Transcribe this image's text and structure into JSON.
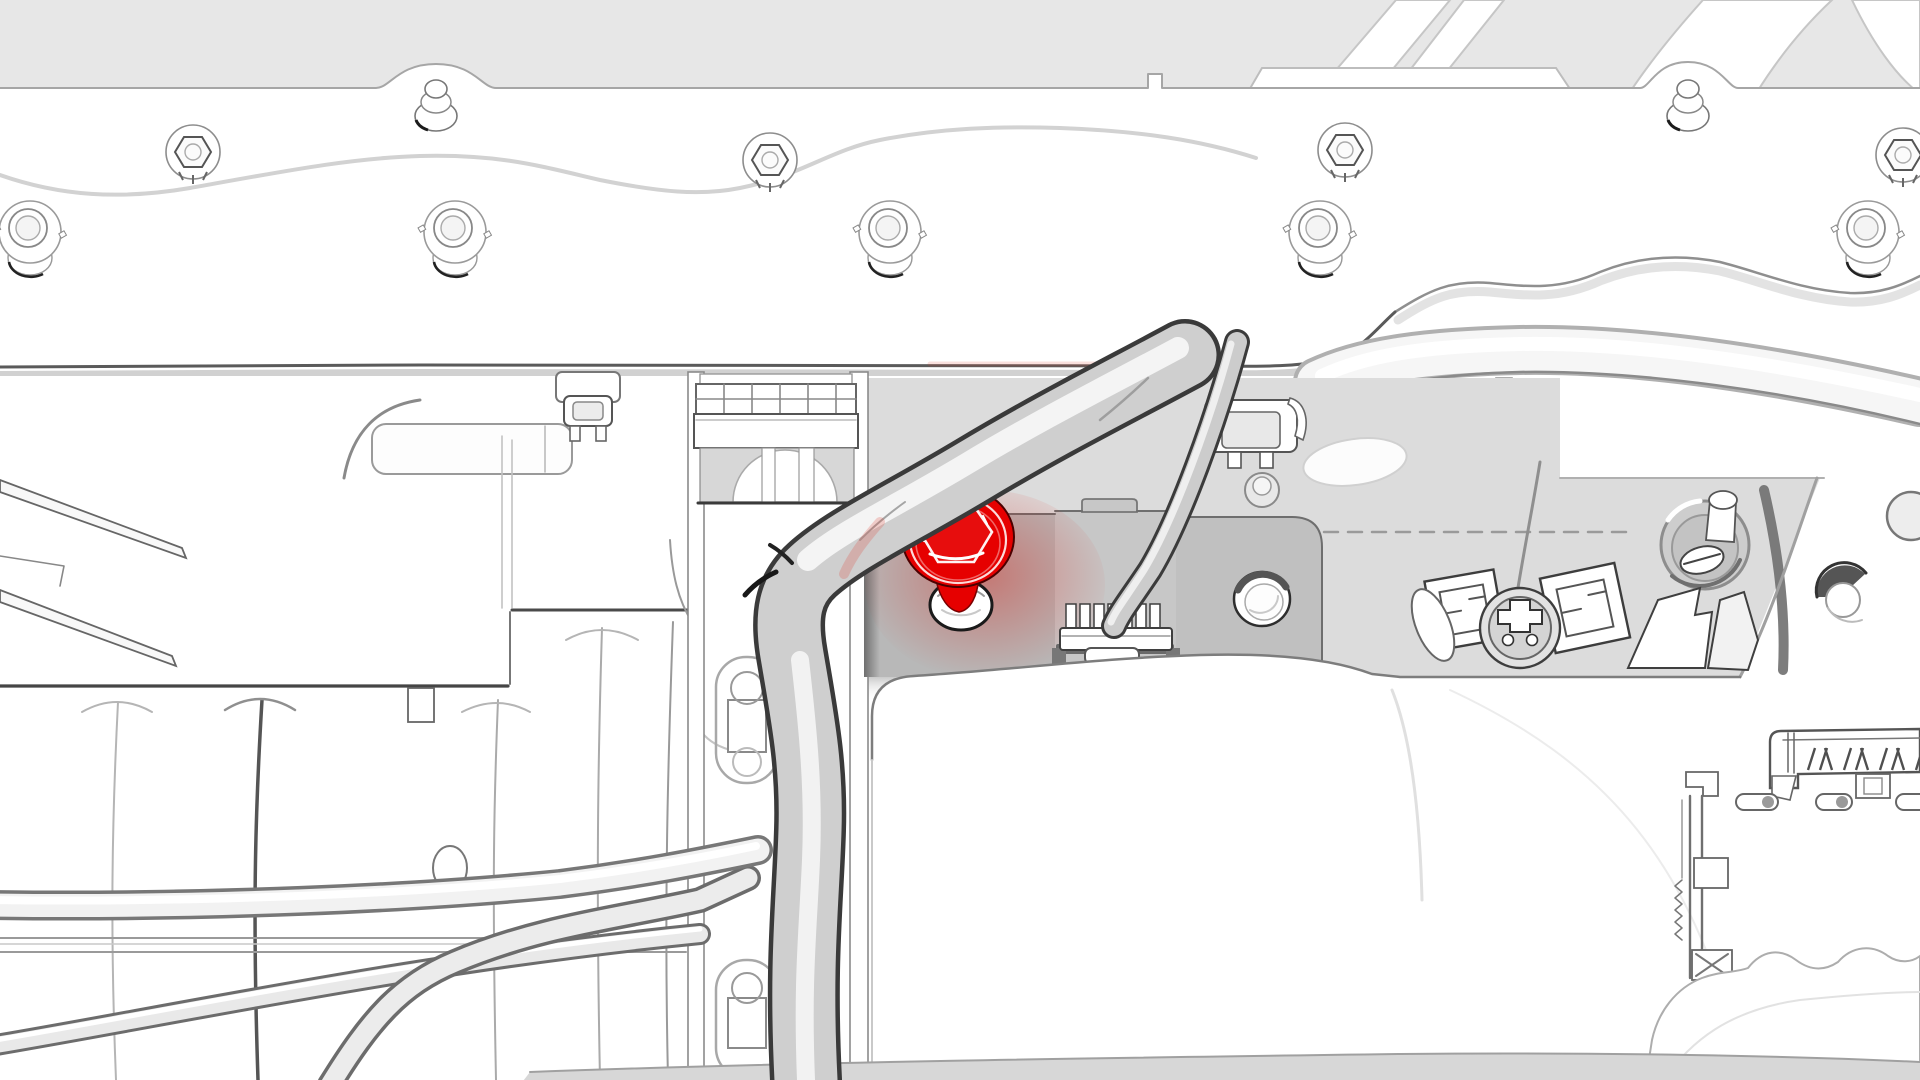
{
  "illustration": {
    "kind": "service-manual-line-illustration",
    "scene": "vehicle-underbody-front-area",
    "highlighted_part": "hex-head-fastener",
    "visible_text": ""
  },
  "colors": {
    "background": "#e7e7e7",
    "white": "#ffffff",
    "highlight_red": "#e60000",
    "highlight_red_dark": "#7a0000",
    "recess": "#dcdcdc",
    "bracket_left": "#b8b8b8",
    "bracket_mid": "#c7c7c7",
    "bracket_right": "#c0c0c0",
    "cavity": "#d7d7d7",
    "tube_fill": "#cfcfcf",
    "tube_outline": "#3a3a3a",
    "edge_dark": "#585858",
    "edge_soft": "#a8a8a8",
    "dash_line": "#9a9a9a"
  },
  "parts": [
    "top-crossmember-rail",
    "hex-flange-bolt",
    "stud-fastener",
    "flanged-bushing",
    "mounting-strap",
    "coolant-pipe",
    "pipe-clamp",
    "cable-clip",
    "harness-tube",
    "signal-cable",
    "highlighted-fastener",
    "fastener-grommet-hole",
    "wire-connector",
    "mounting-bracket",
    "bracket-hole",
    "grommet-stud",
    "maze-clip",
    "round-connector",
    "torn-bracket",
    "drain-hole",
    "duct-grille",
    "duct-housing",
    "hose-junction",
    "floor-cover",
    "serrated-rail",
    "multi-pin-connector-block",
    "scalloped-cover"
  ]
}
